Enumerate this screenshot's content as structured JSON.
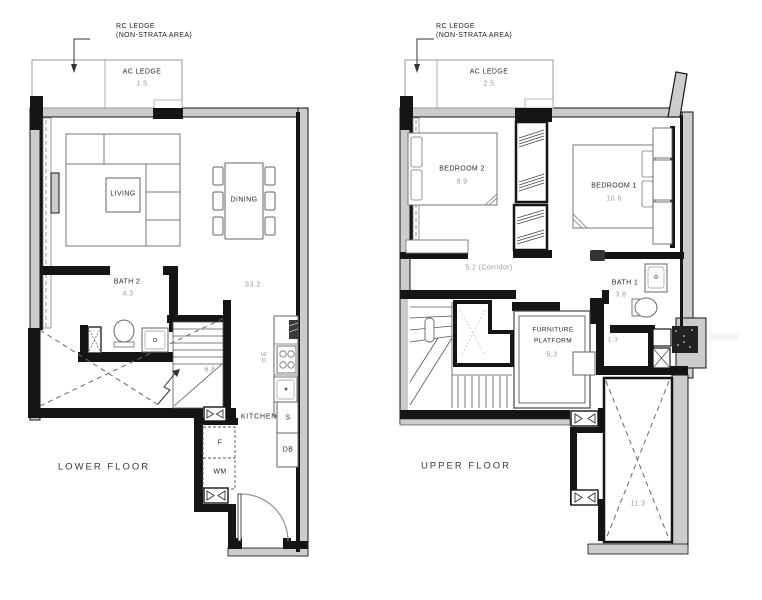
{
  "colors": {
    "wall": "#151515",
    "poche": "#cccccc",
    "area_text": "#9b9b9b",
    "label_text": "#2a2a2a"
  },
  "lower_floor": {
    "floor_label": "LOWER FLOOR",
    "rc_ledge": {
      "line1": "RC LEDGE",
      "line2": "(NON-STRATA AREA)"
    },
    "ac_ledge": {
      "label": "AC LEDGE",
      "area": "1.5"
    },
    "living": {
      "label": "LIVING"
    },
    "dining": {
      "label": "DINING"
    },
    "main_area": "33.2",
    "bath2": {
      "label": "BATH 2",
      "area": "4.3"
    },
    "stairs_area": "6.8",
    "kitchen": {
      "label": "KITCHEN",
      "hood_line1": "H/",
      "hood_line2": "D",
      "sink": "S",
      "db": "DB",
      "fridge": "F",
      "washer": "WM"
    }
  },
  "upper_floor": {
    "floor_label": "UPPER FLOOR",
    "rc_ledge": {
      "line1": "RC LEDGE",
      "line2": "(NON-STRATA AREA)"
    },
    "ac_ledge": {
      "label": "AC LEDGE",
      "area": "2.5"
    },
    "bedroom2": {
      "label": "BEDROOM 2",
      "area": "8.9"
    },
    "bedroom1": {
      "label": "BEDROOM 1",
      "area": "10.6"
    },
    "corridor": "5.2 (Corridor)",
    "bath1": {
      "label": "BATH 1",
      "area": "3.8"
    },
    "furniture_platform": {
      "line1": "FURNITURE",
      "line2": "PLATFORM",
      "area": "5.3"
    },
    "ledge_area": "1.3",
    "void_area": "11.3"
  },
  "watermark": "e.ouoio"
}
